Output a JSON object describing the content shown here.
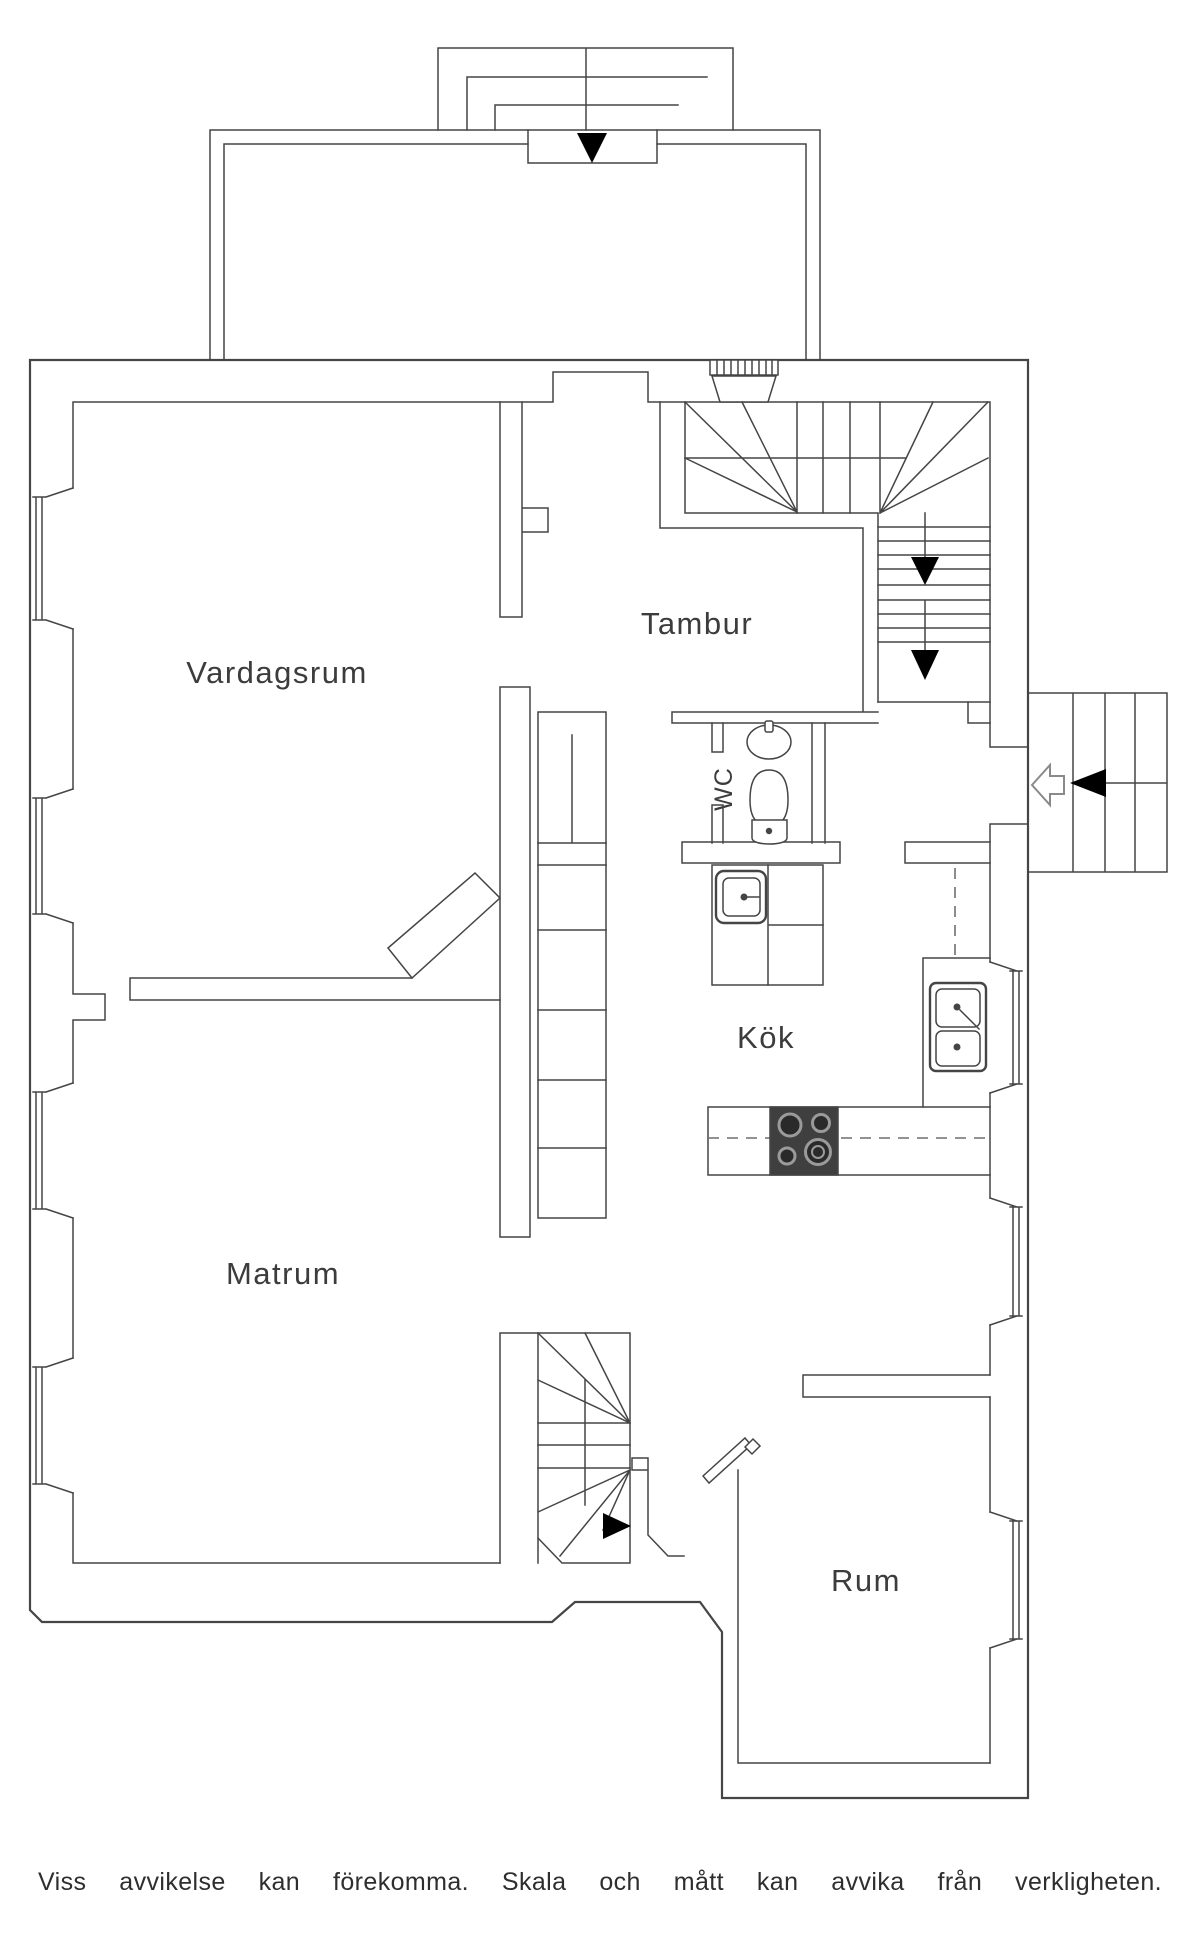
{
  "plan": {
    "rooms": {
      "vardagsrum": "Vardagsrum",
      "tambur": "Tambur",
      "wc": "WC",
      "kok": "Kök",
      "matrum": "Matrum",
      "rum": "Rum"
    },
    "icons": [
      "entry-arrow-down-icon",
      "stair-down-arrow-icon",
      "stair-down-arrow-icon",
      "side-entry-arrow-left-icon",
      "door-swing-arrow-icon",
      "basement-stair-arrow-right-icon"
    ],
    "colors": {
      "line": "#454545",
      "arrow_black": "#000000",
      "stove_body": "#3f3f3f",
      "burner_ring": "#8a8a8a"
    }
  },
  "footer": {
    "disclaimer": "Viss avvikelse kan förekomma. Skala och mått kan avvika från verkligheten."
  }
}
